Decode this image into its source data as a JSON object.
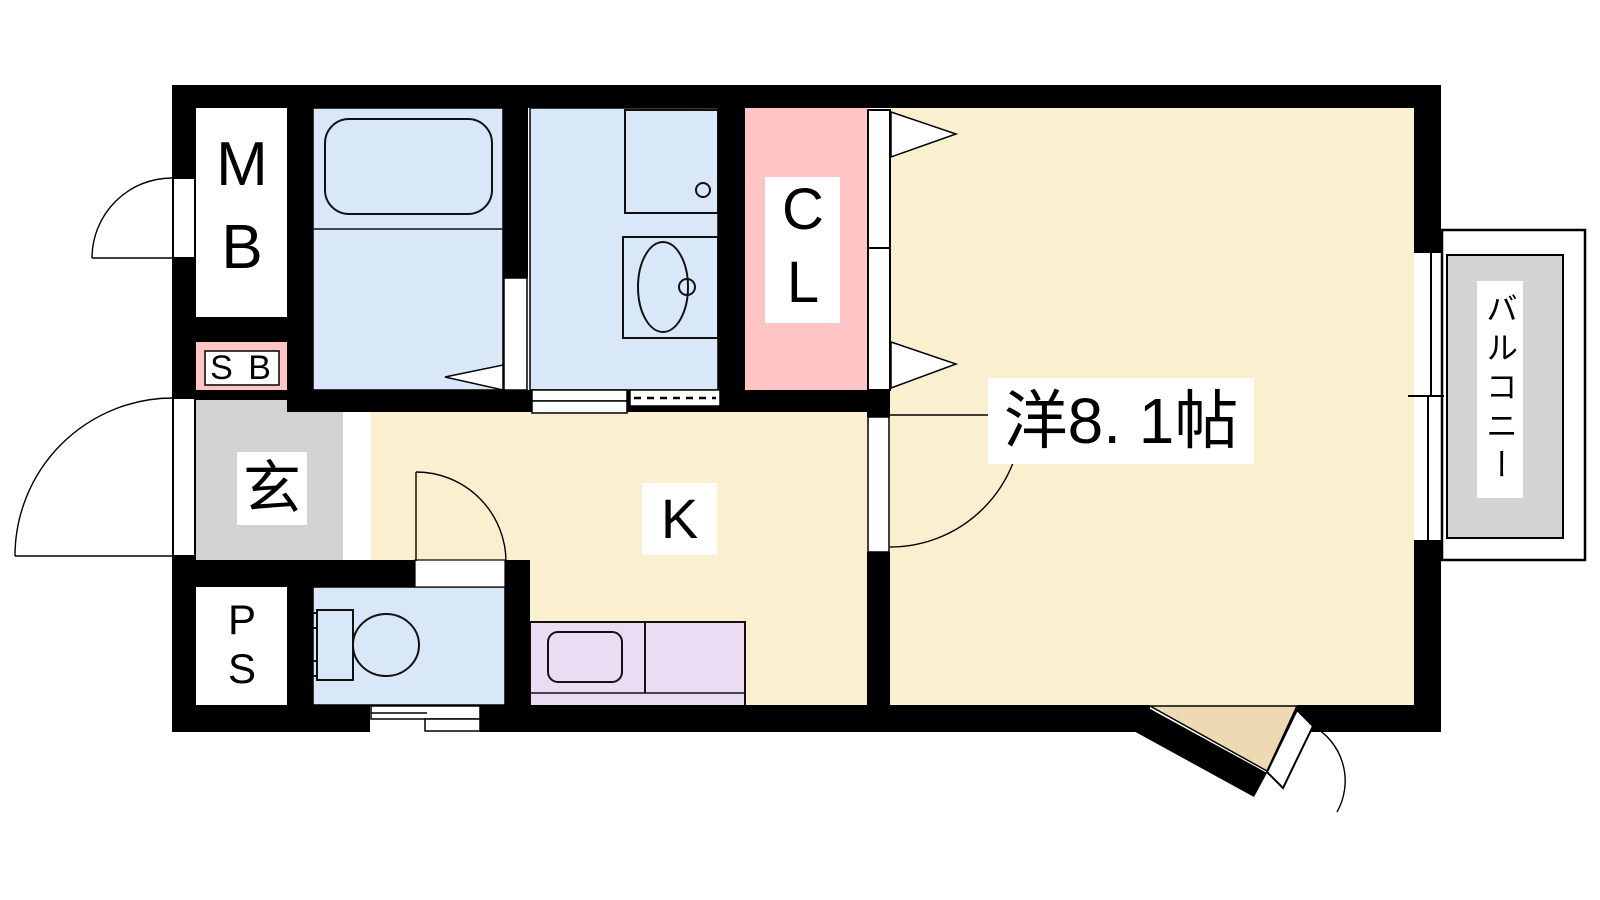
{
  "labels": {
    "meter_box": "MB",
    "shaft_box": "S B",
    "entrance": "玄",
    "pipe_space": "PS",
    "closet": "CL",
    "kitchen": "K",
    "western_room": "洋8. 1帖",
    "balcony": "バルコニー"
  },
  "colors": {
    "wall": "#000000",
    "floor_beige": "#FAF0D0",
    "wet_area_blue": "#D8E8F8",
    "closet_pink": "#FFC4C4",
    "entrance_gray": "#D2D2D2",
    "balcony_gray": "#D4D4D4",
    "counter_lavender": "#E9DCF3",
    "step_tan": "#EDDAB3"
  }
}
